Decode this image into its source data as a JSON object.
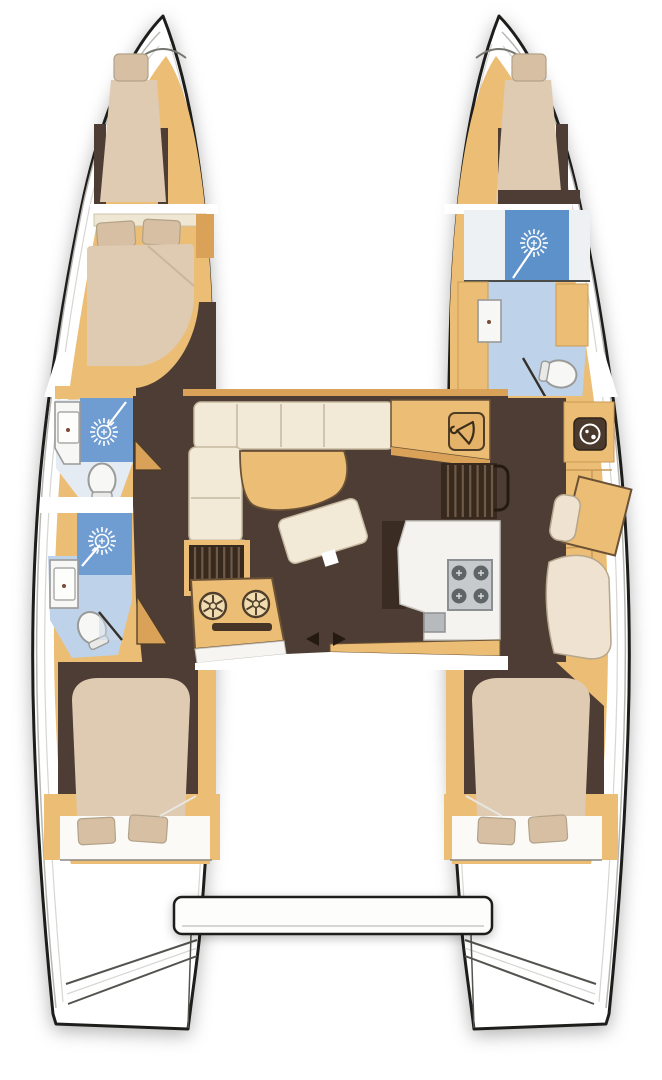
{
  "document": {
    "kind": "catamaran sailboat floor plan, top-down accommodation layout",
    "orientation": "bow at top, stern at bottom",
    "visible_text": "none"
  },
  "colors": {
    "hull-outline": "#1d1d1b",
    "deck-white": "#ffffff",
    "wood": "#ecbd74",
    "wood-dark": "#d9a258",
    "floor-dark": "#4d3d34",
    "mattress": "#dfcab2",
    "mattress-light": "#efe2d0",
    "pillow": "#d7bfa4",
    "shower-blue": "#6f9cd1",
    "shower-blue-deep": "#5d91c9",
    "bath-floor": "#bed3ea",
    "fixture-white": "#f7f7f5",
    "fixture-edge": "#9a9a98",
    "steel": "#c7cacc",
    "line-gray": "#b9b7b4"
  },
  "vessel": {
    "hull_count": 2,
    "port_hull": {
      "name": "port hull",
      "rooms": [
        {
          "name": "port bow berth",
          "features": [
            "single berth",
            "pillow"
          ]
        },
        {
          "name": "port forward double cabin",
          "features": [
            "double bed",
            "two pillows"
          ]
        },
        {
          "name": "port forward bathroom",
          "features": [
            "shower",
            "washbasin",
            "toilet"
          ]
        },
        {
          "name": "port aft bathroom",
          "features": [
            "shower",
            "washbasin",
            "toilet"
          ]
        },
        {
          "name": "port corridor",
          "features": [
            "cabin doors"
          ]
        },
        {
          "name": "port aft double cabin",
          "features": [
            "double bed",
            "two pillows"
          ]
        },
        {
          "name": "port transom steps",
          "features": [
            "swim steps"
          ]
        }
      ]
    },
    "starboard_hull": {
      "name": "starboard hull",
      "rooms": [
        {
          "name": "starboard bow berth",
          "features": [
            "single berth",
            "pillow"
          ]
        },
        {
          "name": "starboard shower room",
          "features": [
            "shower"
          ]
        },
        {
          "name": "starboard bathroom",
          "features": [
            "washbasin",
            "toilet"
          ]
        },
        {
          "name": "starboard study and dressing area",
          "features": [
            "washing machine",
            "desk",
            "seat",
            "lounge seat",
            "shelving"
          ]
        },
        {
          "name": "starboard aft double cabin",
          "features": [
            "double bed",
            "two pillows"
          ]
        },
        {
          "name": "starboard transom steps",
          "features": [
            "swim steps"
          ]
        }
      ]
    },
    "salon": {
      "name": "salon and galley",
      "features": [
        "L-shaped sofa",
        "curved salon table",
        "angled chaise seat",
        "sideboard",
        "wardrobe with hanger",
        "companionway steps to port hull",
        "companionway steps to starboard hull",
        "galley counter",
        "four-burner stove",
        "galley sink",
        "twin round sinks console",
        "sliding door arrows"
      ]
    },
    "stern": {
      "name": "aft platform",
      "features": [
        "transom platform between hulls"
      ]
    },
    "icons": [
      "shower-icon",
      "toilet-icon",
      "washbasin-icon",
      "hanger-icon",
      "washing-machine-icon",
      "stove-icon",
      "sink-drain-icon",
      "companionway-steps",
      "door-swing",
      "sliding-door-arrows"
    ]
  }
}
